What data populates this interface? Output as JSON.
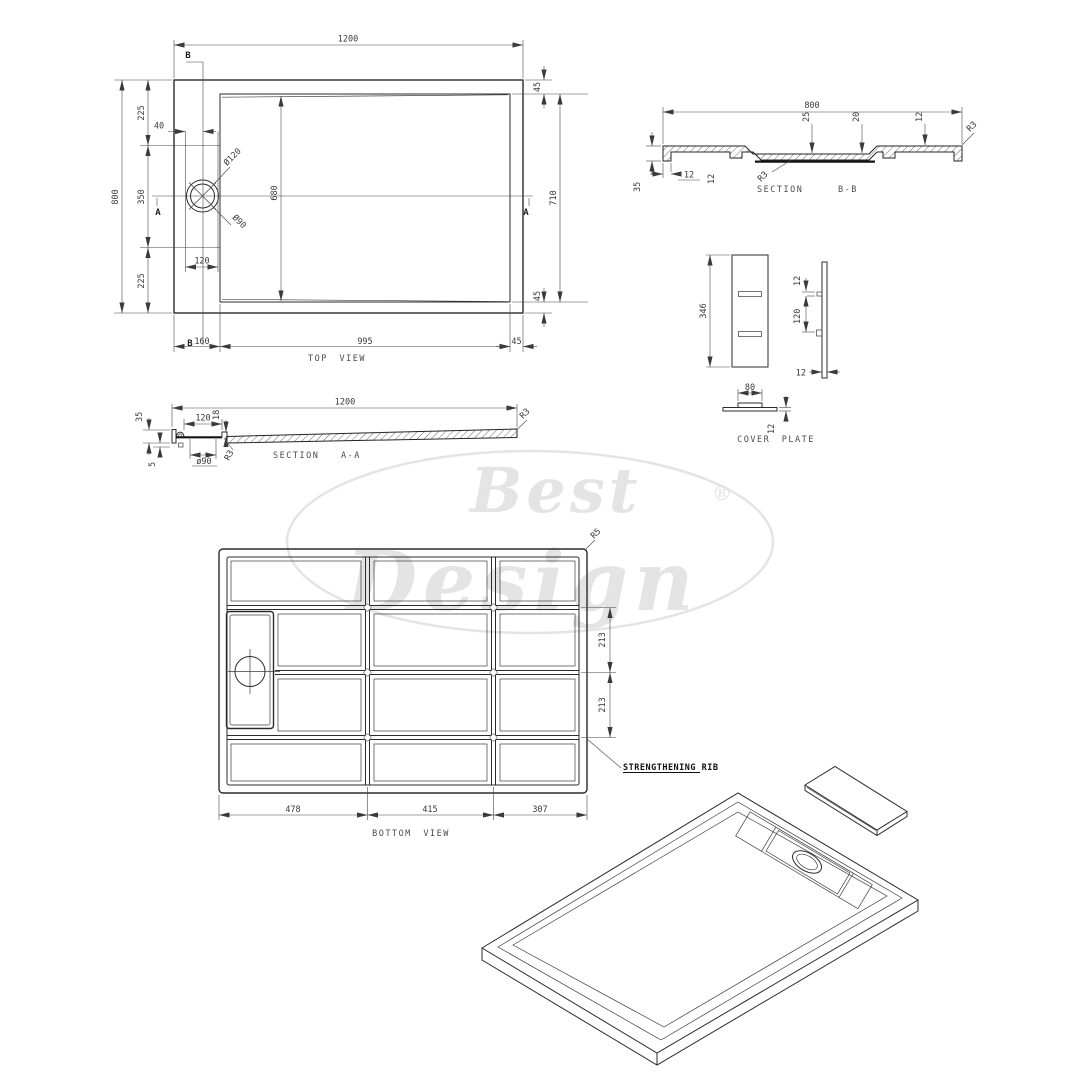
{
  "watermark": {
    "word1": "Best",
    "word2": "Design",
    "reg": "®"
  },
  "top_view": {
    "label": "TOP VIEW",
    "marker_a": "A",
    "marker_b": "B",
    "d1200": "1200",
    "d800": "800",
    "d225t": "225",
    "d40": "40",
    "d350": "350",
    "d225b": "225",
    "dia120": "Ø120",
    "dia90": "Ø90",
    "d680": "680",
    "d120": "120",
    "d160": "160",
    "d995": "995",
    "d45": "45",
    "d710": "710"
  },
  "section_bb": {
    "label_section": "SECTION",
    "label_name": "B-B",
    "d800": "800",
    "d25": "25",
    "d20": "20",
    "d12t": "12",
    "r3_corner": "R3",
    "r3_center": "R3",
    "d35": "35",
    "d12a": "12",
    "d12b": "12"
  },
  "cover_plate": {
    "label": "COVER PLATE",
    "d346": "346",
    "d12t": "12",
    "d120": "120",
    "d12s": "12",
    "d80": "80",
    "d12b": "12"
  },
  "section_aa": {
    "label_section": "SECTION",
    "label_name": "A-A",
    "d1200": "1200",
    "d35": "35",
    "d120": "120",
    "d18": "18",
    "d5": "5",
    "dia90": "ø90",
    "r3a": "R3",
    "r3b": "R3"
  },
  "bottom_view": {
    "label": "BOTTOM VIEW",
    "rib": "STRENGTHENING RIB",
    "d478": "478",
    "d415": "415",
    "d307": "307",
    "d213a": "213",
    "d213b": "213",
    "r5": "R5"
  }
}
